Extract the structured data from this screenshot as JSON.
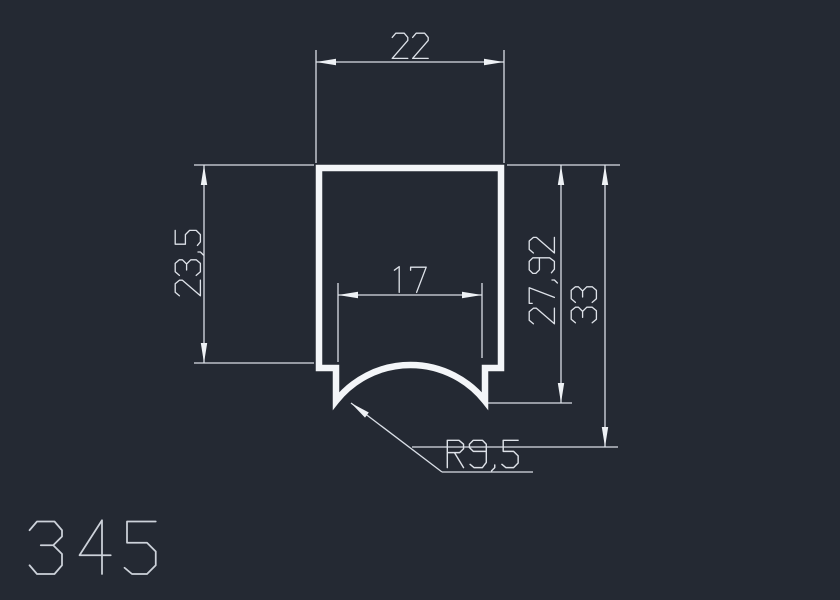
{
  "drawing": {
    "part_number": "345",
    "dimensions": {
      "top_width": "22",
      "left_height": "23,5",
      "slot_width": "17",
      "inner_height": "27,92",
      "overall_height": "33",
      "radius": "R9,5"
    }
  },
  "colors": {
    "background": "#242933",
    "profile_line": "#f3f5f8",
    "dimension_line": "#d9dee6",
    "dimension_text": "#dde1e8",
    "title_text": "#cdd2da"
  }
}
